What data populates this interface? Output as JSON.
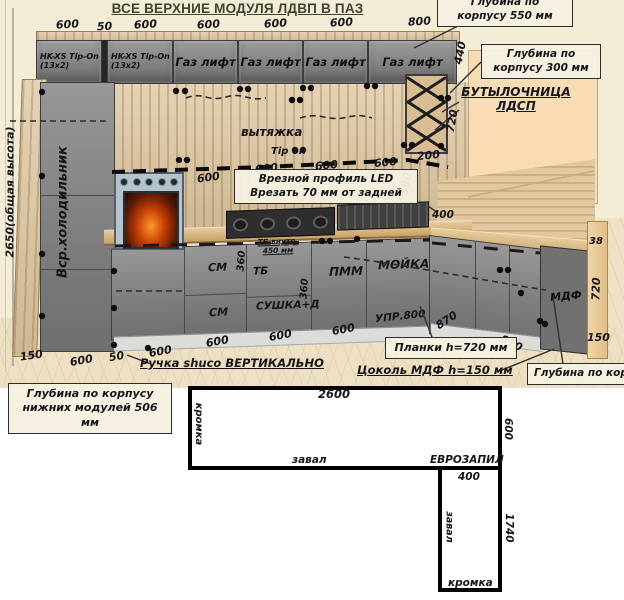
{
  "title": "ВСЕ ВЕРХНИЕ МОДУЛЯ ЛДВП В ПАЗ",
  "upper": {
    "dims": [
      "600",
      "50",
      "600",
      "600",
      "600",
      "600",
      "800"
    ],
    "cabinets": [
      "HK-XS Tip-On\n(13x2)",
      "HK-XS Tip-On\n(13x2)",
      "Газ лифт",
      "Газ лифт",
      "Газ лифт",
      "Газ лифт"
    ],
    "dim_440": "440"
  },
  "wall": {
    "hood": "вытяжка",
    "tip_on": "Tip on",
    "dims": [
      "600",
      "600",
      "600",
      "600"
    ],
    "dim_200": "200",
    "dim_580": "580",
    "dim_720": "720"
  },
  "left": {
    "height": "2650(общая высота)",
    "fridge": "Вср.холодильник"
  },
  "base": {
    "sm_top": "СМ",
    "sm_bottom": "СМ",
    "tb": "ТБ",
    "tb_note": "ТБ внутр.\n450 мм",
    "sushka": "СУШКА+Д",
    "pmm": "ПММ",
    "moyka": "МОЙКА",
    "upr": "УПР.800",
    "mdf": "МДФ",
    "dim_360a": "360",
    "dim_360b": "360",
    "dim_400": "400",
    "dim_870a": "870",
    "dim_870b": "870",
    "dim_38": "38",
    "dim_720": "720",
    "dim_150": "150"
  },
  "bottom_dims": [
    "150",
    "600",
    "50",
    "600",
    "600",
    "600",
    "600"
  ],
  "notes": {
    "depth550": "Глубина по\nкорпусу 550 мм",
    "depth300": "Глубина по\nкорпусу 300 мм",
    "bottle": "БУТЫЛОЧНИЦА\nЛДСП",
    "led": "Врезной профиль LED\nВрезать 70 мм от задней",
    "lower_depth": "Глубина по корпусу\nнижних модулей 506 мм",
    "planki": "Планки h=720 мм",
    "tsokol": "Цоколь МДФ h=150 мм",
    "right_depth": "Глубина по корпусу",
    "handle": "Ручка shuco ВЕРТИКАЛЬНО"
  },
  "plan": {
    "top": "2600",
    "kromka_left": "кромка",
    "zaval_bottom": "завал",
    "evro": "ЕВРОЗАПИЛ",
    "width": "400",
    "right": "600",
    "length": "1740",
    "zaval_side": "завал",
    "kromka_end": "кромка"
  }
}
